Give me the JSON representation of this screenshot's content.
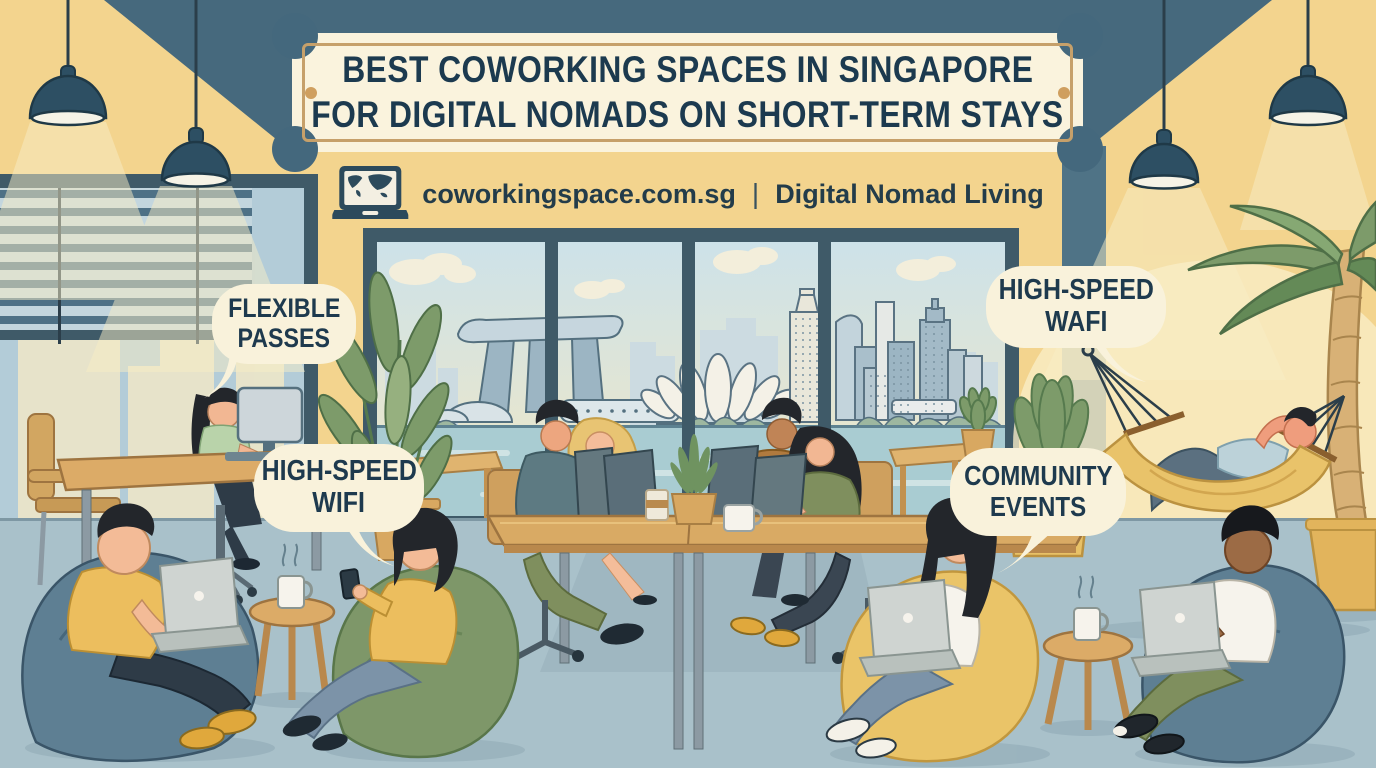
{
  "banner": {
    "line1": "BEST COWORKING SPACES IN SINGAPORE",
    "line2": "FOR DIGITAL NOMADS ON SHORT-TERM STAYS"
  },
  "subtitle": {
    "site": "coworkingspace.com.sg",
    "separator": "|",
    "tagline": "Digital Nomad Living"
  },
  "bubbles": {
    "flexible_passes": {
      "line1": "FLEXIBLE",
      "line2": "PASSES"
    },
    "high_speed_wifi": {
      "line1": "HIGH-SPEED",
      "line2": "WIFI"
    },
    "high_speed_wafi": {
      "line1": "HIGH-SPEED",
      "line2": "WAFI"
    },
    "community_events": {
      "line1": "COMMUNITY",
      "line2": "EVENTS"
    }
  },
  "icons": {
    "laptop_globe": "laptop-globe-icon"
  },
  "colors": {
    "wall": "#f3d48e",
    "ceiling": "#46697d",
    "banner_bg": "#faf3dd",
    "banner_border": "#c6a06a",
    "banner_text": "#1c3a4f",
    "bubble_bg": "#f9f2db",
    "floor": "#a9c1ca",
    "window_frame": "#3f5a68",
    "sky": "#cde2e9",
    "water": "#a9ccd2",
    "beanbag_blue": "#5e7f93",
    "beanbag_green": "#7e9769",
    "beanbag_yellow": "#eac468",
    "hammock": "#e9c36a",
    "plant_green": "#7d9b6a",
    "wood": "#dcab67",
    "accent_yellow": "#ecbe5e"
  }
}
